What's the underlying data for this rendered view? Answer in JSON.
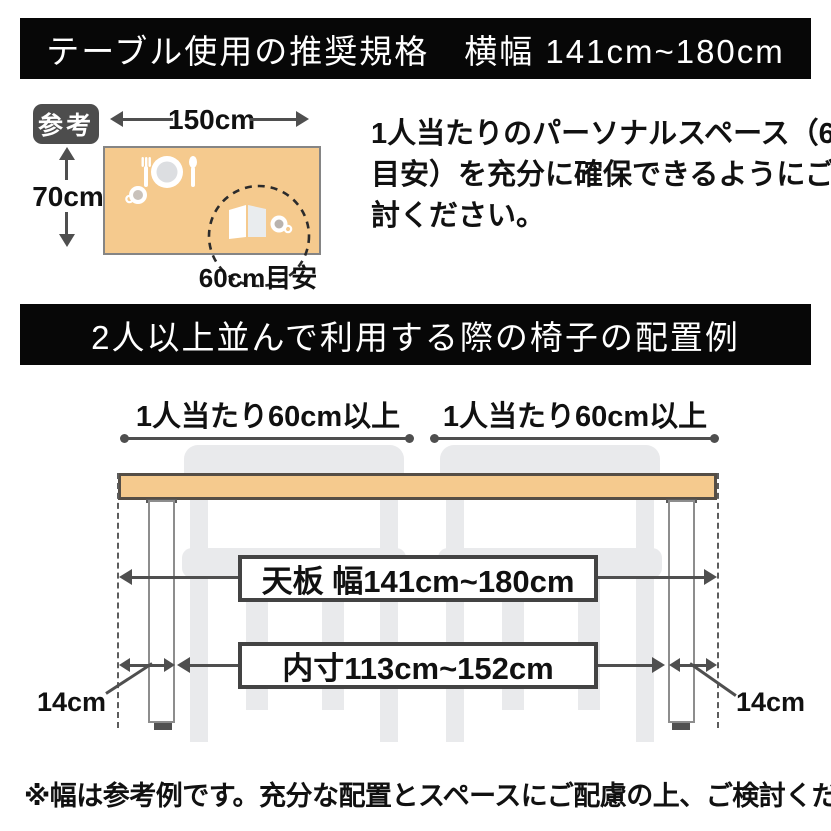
{
  "header_banner": {
    "text": "テーブル使用の推奨規格　横幅 141cm~180cm"
  },
  "reference_section": {
    "badge": "参考",
    "table_width_label": "150cm",
    "table_depth_label": "70cm",
    "personal_space_circle_label": "60cm目安",
    "description_lines": [
      "1人当たりのパーソナルスペース（60cm",
      "目安）を充分に確保できるようにご検",
      "討ください。"
    ]
  },
  "arrangement_banner": {
    "text": "2人以上並んで利用する際の椅子の配置例"
  },
  "arrangement_diagram": {
    "per_person_label": "1人当たり60cm以上",
    "tabletop_width_label": "天板 幅141cm~180cm",
    "inner_width_label": "内寸113cm~152cm",
    "leg_offset_label": "14cm"
  },
  "footnote": "※幅は参考例です。充分な配置とスペースにご配慮の上、ご検討ください。",
  "icons": {
    "fork": "fork-icon",
    "plate": "plate-icon",
    "spoon": "spoon-icon",
    "coffee_cup": "coffee-cup-icon",
    "open_book": "open-book-icon",
    "teacup": "teacup-icon",
    "personal_space_circle": "dashed-circle-icon"
  },
  "colors": {
    "banner_bg": "#070707",
    "banner_text": "#ffffff",
    "tabletop": "#f5ca8e",
    "tabletop_border": "#554e46",
    "badge_bg": "#4d4d4d",
    "dimension": "#4f4f4f",
    "chair": "#e9eaec",
    "text": "#111111"
  }
}
